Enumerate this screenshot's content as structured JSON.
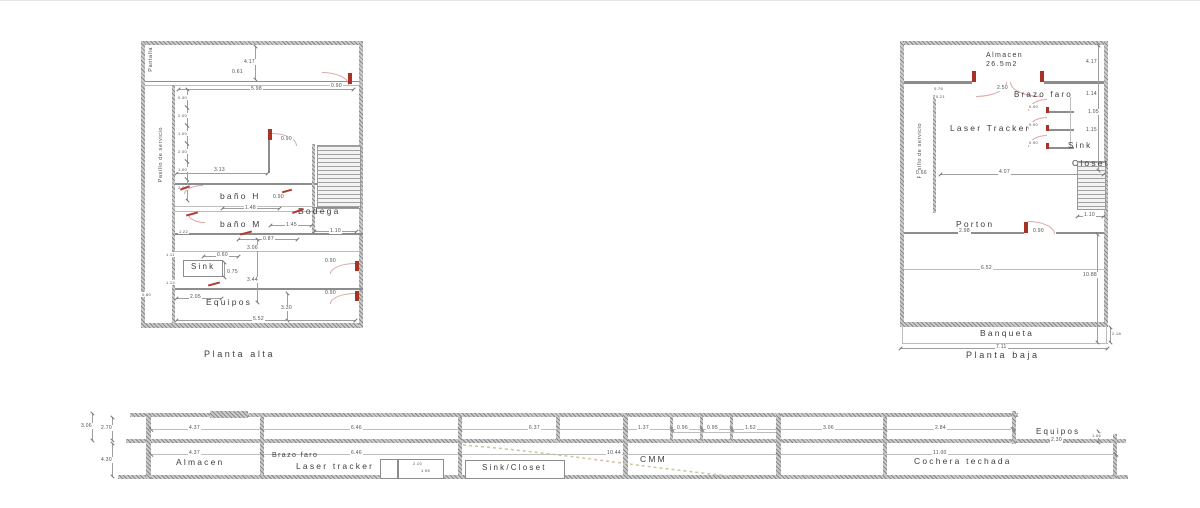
{
  "colors": {
    "background": "#ffffff",
    "wall_gray": "#cbcbcb",
    "line_gray": "#8d8d8d",
    "dim_text": "#4f4f4f",
    "door_red": "#a93226",
    "arc_pink": "#dba7a7",
    "spline_tan": "#cfc49a"
  },
  "planta_alta": {
    "title": "Planta alta",
    "pantalla": "Pantalla",
    "pasillo": "Pasillo de servicio",
    "rooms": {
      "bano_h": "baño H",
      "bano_m": "baño M",
      "bodega": "Bodega",
      "sink": "Sink",
      "equipos": "Equipos"
    },
    "dims": {
      "v417": "4.17",
      "h061": "0.61",
      "h598": "5.98",
      "h313": "3.13",
      "d090": "0.90",
      "h148": "1.48",
      "h145": "1.45",
      "h110": "1.10",
      "h087": "0.87",
      "v306": "3.06",
      "v344": "3.44",
      "v330": "3.30",
      "h552": "5.52",
      "h205": "2.05",
      "h060": "0.60",
      "v075": "0.75",
      "v111": "1.11",
      "v114": "1.14",
      "v122": "1.22",
      "v080": "0.80",
      "stack": [
        "0.30",
        "2.00",
        "1.00",
        "2.00",
        "1.00",
        "2.00"
      ]
    }
  },
  "planta_baja": {
    "title": "Planta baja",
    "pasillo": "Pasillo de servicio",
    "rooms": {
      "almacen": "Almacen",
      "almacen_area": "26.5m2",
      "brazo_faro": "Brazo faro",
      "laser_tracker": "Laser Tracker",
      "sink": "Sink",
      "closet": "Closet",
      "porton": "Porton",
      "banqueta": "Banqueta"
    },
    "dims": {
      "v417": "4.17",
      "v114": "1.14",
      "v105": "1.05",
      "v115": "1.15",
      "h076": "0.76",
      "h021": "0.21",
      "h250": "2.50",
      "d090": "0.90",
      "h066": "0.66",
      "h407": "4.07",
      "h110": "1.10",
      "h298": "2.98",
      "h652": "6.52",
      "v1088": "10.88",
      "v218": "2.18",
      "h711": "7.11"
    }
  },
  "seccion": {
    "rooms": {
      "almacen": "Almacen",
      "brazo_faro": "Brazo faro",
      "laser_tracker": "Laser tracker",
      "sink_closet": "Sink/Closet",
      "cmm": "CMM",
      "cochera": "Cochera techada",
      "equipos": "Equipos"
    },
    "dims": {
      "row1": [
        "4.37",
        "6.46",
        "6.37",
        "1.37",
        "0.96",
        "0.95",
        "1.52",
        "3.06",
        "2.84"
      ],
      "row2": [
        "4.37",
        "6.46",
        "10.44",
        "11.00"
      ],
      "left": [
        "3.06",
        "2.70",
        "4.30"
      ],
      "closet": [
        "2.10",
        "1.95"
      ],
      "equipos": [
        "2.30",
        "1.06"
      ]
    }
  }
}
